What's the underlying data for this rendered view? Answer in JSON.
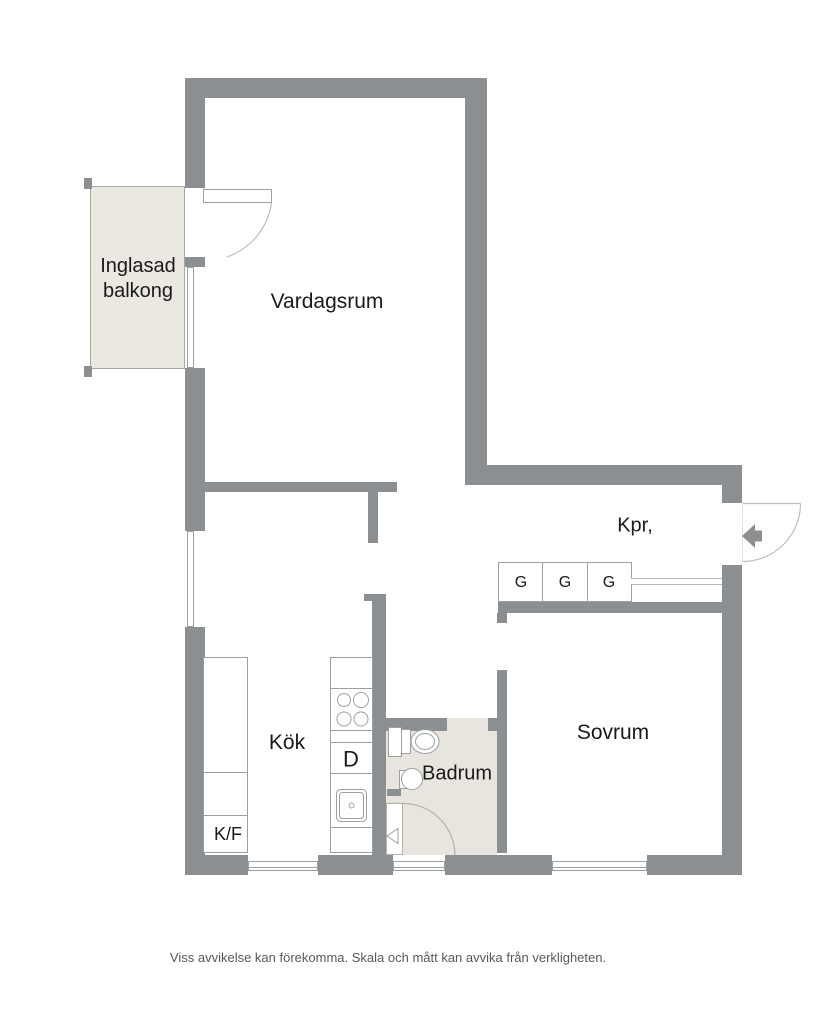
{
  "floorplan": {
    "rooms": {
      "balcony": {
        "label_line1": "Inglasad",
        "label_line2": "balkong"
      },
      "living_room": {
        "label": "Vardagsrum"
      },
      "closet": {
        "label": "Kpr,"
      },
      "wardrobes": [
        "G",
        "G",
        "G"
      ],
      "bedroom": {
        "label": "Sovrum"
      },
      "kitchen": {
        "label": "Kök"
      },
      "bathroom": {
        "label": "Badrum"
      },
      "appliances": {
        "fridge_freezer": "K/F",
        "dishwasher": "D"
      }
    },
    "disclaimer": "Viss avvikelse kan förekomma. Skala och mått kan avvika från verkligheten.",
    "colors": {
      "wall": "#8c8f91",
      "balcony_fill": "#ebe8e2",
      "bathroom_fill": "#e8e4de",
      "fixture_line": "#9ba0a3",
      "door_arc": "#bdc0c2",
      "label_text": "#1a1a1a",
      "disclaimer_text": "#58595b"
    }
  }
}
